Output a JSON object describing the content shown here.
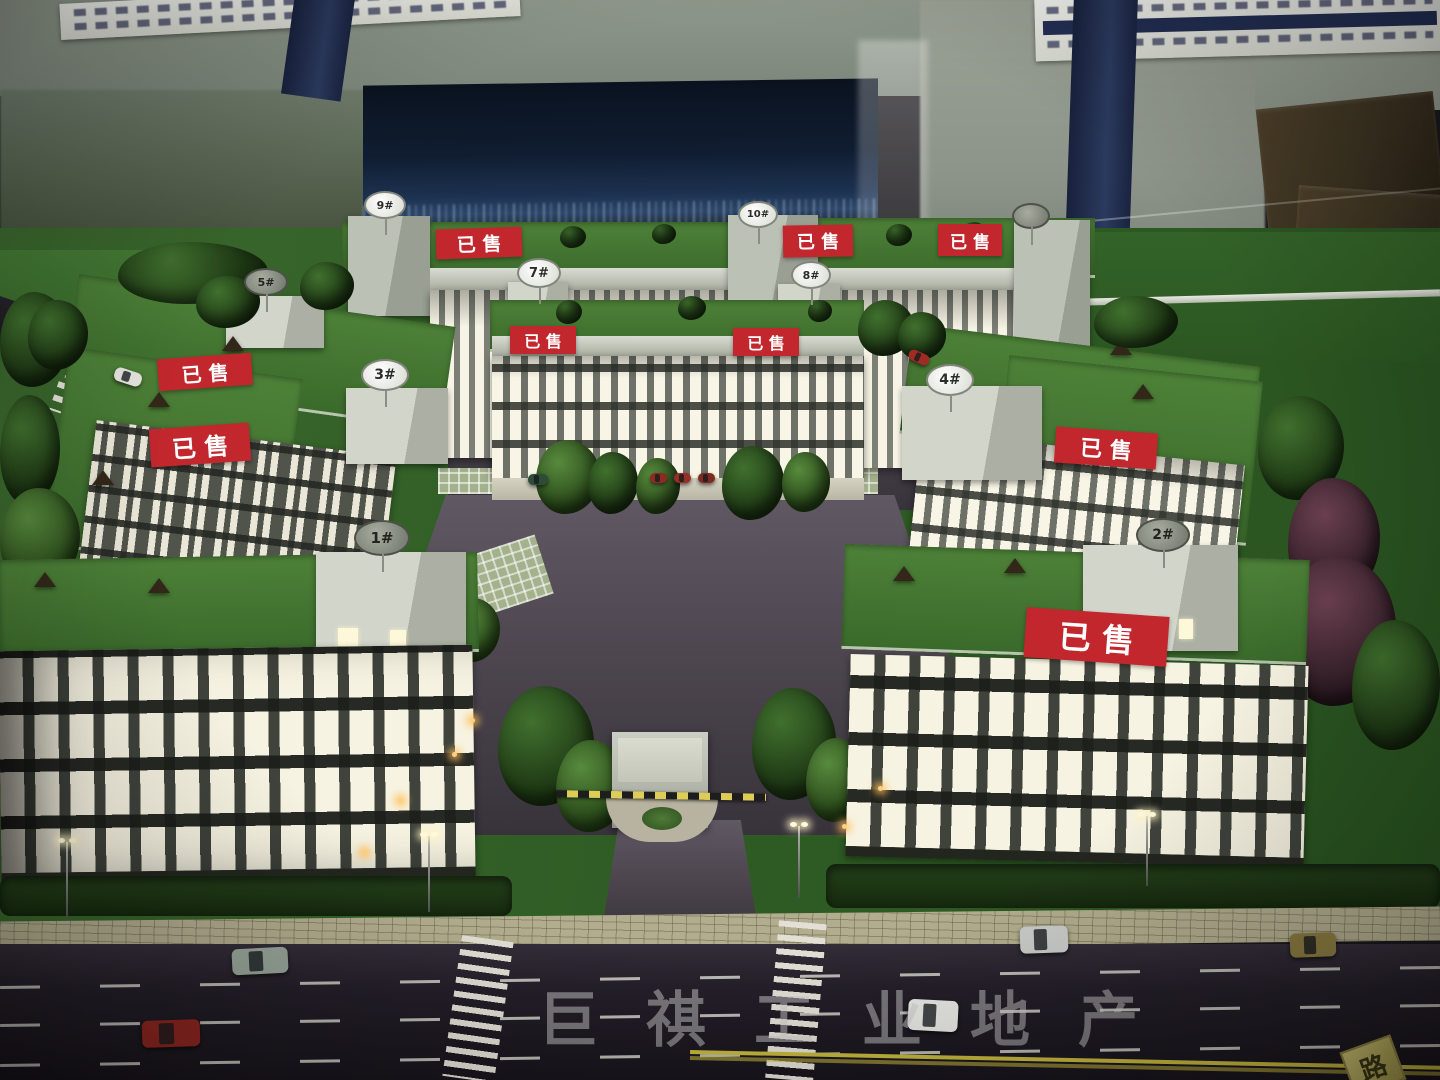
{
  "watermark": {
    "text": "巨祺工业地产"
  },
  "signs": {
    "sold": "已售",
    "road_plate": "路"
  },
  "buildings": {
    "b1": {
      "label": "1#"
    },
    "b2": {
      "label": "2#"
    },
    "b3": {
      "label": "3#"
    },
    "b4": {
      "label": "4#"
    },
    "b5": {
      "label": "5#"
    },
    "b6": {
      "label": ""
    },
    "b7": {
      "label": "7#"
    },
    "b8": {
      "label": "8#"
    },
    "b9": {
      "label": "9#"
    },
    "b10": {
      "label": "10#"
    }
  },
  "colors": {
    "sold_red": "#c1272d",
    "lawn_green": "#3f7433",
    "asphalt": "#26222b",
    "backdrop_navy": "#16243c",
    "watermark_gray": "#cacaca"
  }
}
